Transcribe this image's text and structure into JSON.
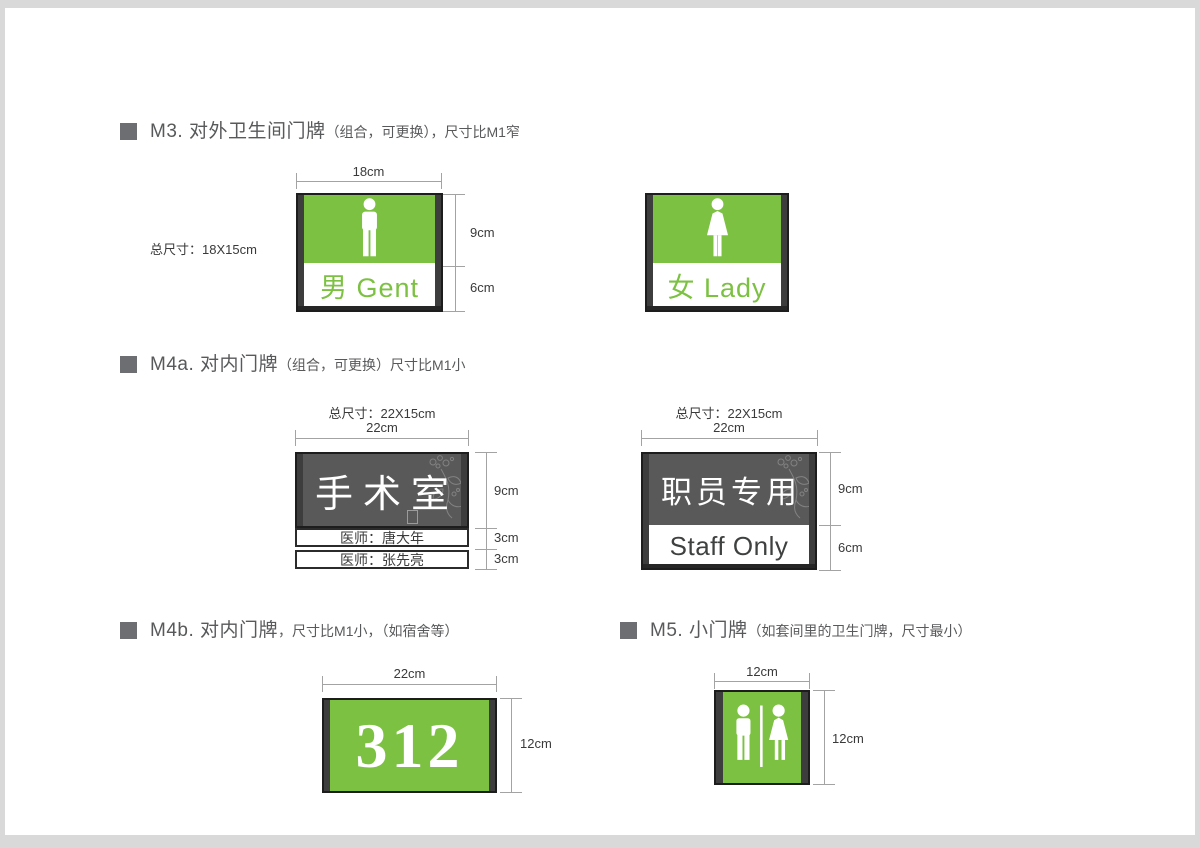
{
  "colors": {
    "sign_green": "#7cc142",
    "panel_gray": "#595959",
    "frame_dark": "#3d3d3d",
    "title_gray": "#58595b"
  },
  "m3": {
    "title_main": "M3. 对外卫生间门牌",
    "title_sub": "（组合，可更换），尺寸比M1窄",
    "total_size": "总尺寸：18X15cm",
    "male_sign": {
      "width_dim": "18cm",
      "upper_dim": "9cm",
      "lower_dim": "6cm",
      "label": "男 Gent"
    },
    "female_sign": {
      "label": "女 Lady"
    }
  },
  "m4a": {
    "title_main": "M4a. 对内门牌",
    "title_sub": "（组合，可更换）尺寸比M1小",
    "surgery_sign": {
      "total_size": "总尺寸：22X15cm",
      "width_dim": "22cm",
      "panel_text": "手术室",
      "slat1": "医师：唐大年",
      "slat2": "医师：张先亮",
      "dim_panel": "9cm",
      "dim_slat1": "3cm",
      "dim_slat2": "3cm"
    },
    "staff_sign": {
      "total_size": "总尺寸：22X15cm",
      "width_dim": "22cm",
      "panel_text": "职员专用",
      "band_text": "Staff Only",
      "dim_panel": "9cm",
      "dim_band": "6cm"
    }
  },
  "m4b": {
    "title_main": "M4b. 对内门牌",
    "title_sub": "，尺寸比M1小，（如宿舍等）",
    "room_sign": {
      "width_dim": "22cm",
      "height_dim": "12cm",
      "number": "312"
    }
  },
  "m5": {
    "title_main": "M5. 小门牌",
    "title_sub": "（如套间里的卫生门牌，尺寸最小）",
    "toilet_sign": {
      "width_dim": "12cm",
      "height_dim": "12cm"
    }
  }
}
